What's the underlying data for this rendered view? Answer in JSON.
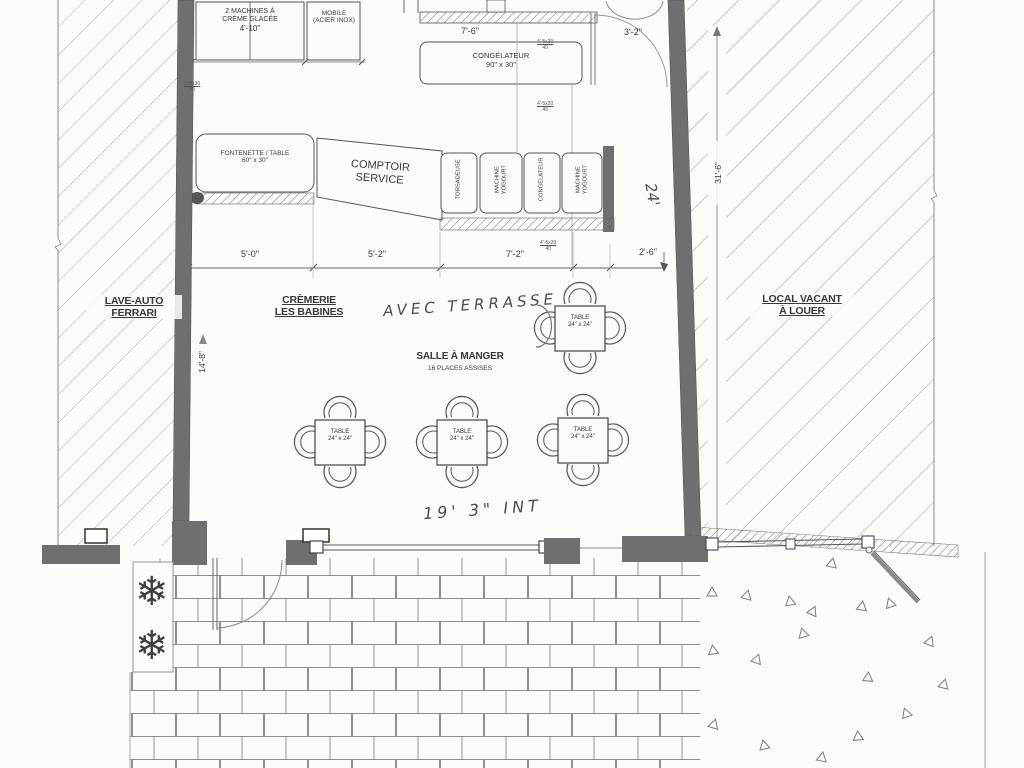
{
  "zones": {
    "lave_auto": {
      "line1": "LAVE-AUTO",
      "line2": "FERRARI"
    },
    "local_vacant": {
      "line1": "LOCAL VACANT",
      "line2": "À LOUER"
    },
    "cremerie": {
      "line1": "CRÈMERIE",
      "line2": "LES BABINES"
    }
  },
  "dining": {
    "title": "SALLE À MANGER",
    "subtitle": "16 PLACES ASSISES"
  },
  "equipment": {
    "ice_cream_machines": {
      "line1": "2 MACHINES À",
      "line2": "CRÈME GLACÉE",
      "size": "4'-10\""
    },
    "mobile": {
      "line1": "MOBILE",
      "line2": "(ACIER INOX)"
    },
    "freezer_top": {
      "name": "CONGÉLATEUR",
      "size": "90\" x 30\""
    },
    "fontenette": {
      "line1": "FONTENETTE / TABLE",
      "line2": "60\" x 30\""
    },
    "comptoir": {
      "line1": "COMPTOIR",
      "line2": "SERVICE"
    },
    "line_units": [
      {
        "l1": "TORSADEUSE"
      },
      {
        "l1": "MACHINE",
        "l2": "YOGOURT"
      },
      {
        "l1": "CONGÉLATEUR"
      },
      {
        "l1": "MACHINE",
        "l2": "YOGOURT"
      }
    ]
  },
  "table": {
    "label": "TABLE",
    "size": "24\" x 24\""
  },
  "dimensions": {
    "top_counter": "7'-6\"",
    "door_right": "3'-2\"",
    "row": [
      "5'-0\"",
      "5'-2\"",
      "7'-2\"",
      "2'-6\""
    ],
    "left_height": "14'-8\"",
    "right_height": "31'-6\""
  },
  "handwritten": {
    "terrasse": "AVEC TERRASSE",
    "storefront": "19' 3\" INT",
    "right_side": "24'"
  },
  "small_marks": [
    {
      "top": "1'-5x30",
      "bot": "40"
    },
    {
      "top": "4'-5x20",
      "bot": "40"
    },
    {
      "top": "4'-5x20",
      "bot": "40"
    },
    {
      "top": "4'-5x20",
      "bot": "40"
    }
  ],
  "icons": {
    "plant": "❄"
  },
  "colors": {
    "ink": "#383838",
    "wall": "#6f6f6f",
    "paper": "#fbfbf8",
    "hatch": "#a5a5a5"
  }
}
